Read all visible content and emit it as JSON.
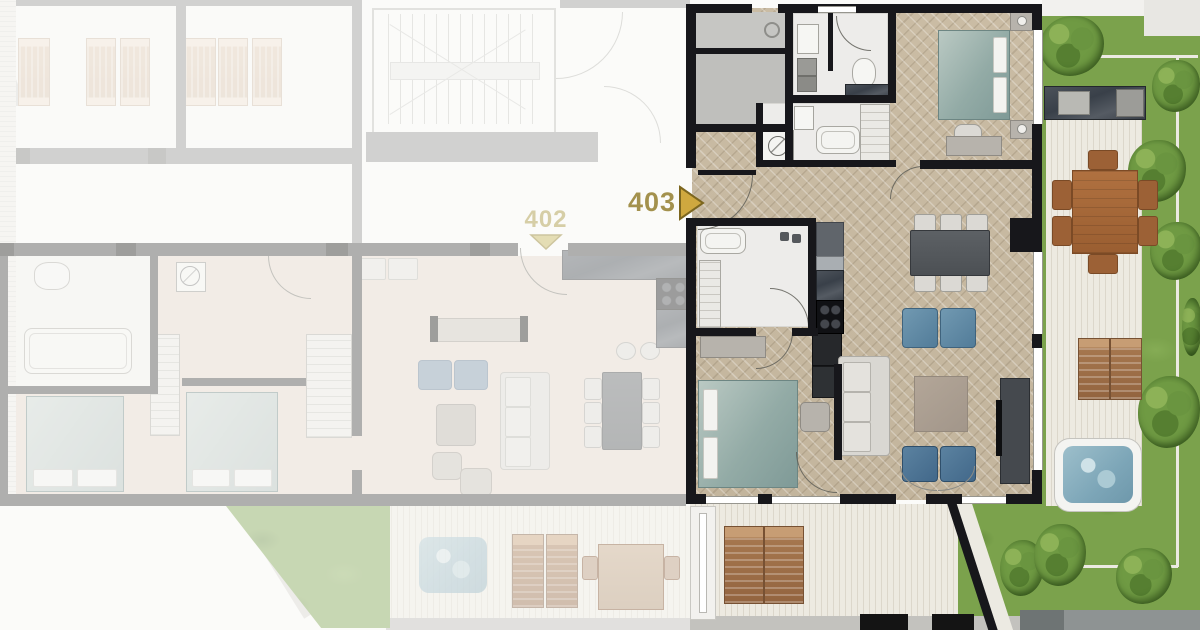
{
  "plan": {
    "view": "residential-floor-plan",
    "units": [
      {
        "label": "403",
        "state": "highlighted",
        "marker": "right-arrow"
      },
      {
        "label": "402",
        "state": "faded",
        "marker": "down-arrow"
      }
    ],
    "palette": {
      "accent_gold": "#c7a53f",
      "label_gold": "#a3914d",
      "wall": "#17171b",
      "wood_floor": "#c8baa2",
      "grass": "#7ba24c",
      "deck": "#e7e3d9",
      "water": "#86abbc",
      "bed_teal": "#9db3ae",
      "upholstery_blue": "#5d86a3",
      "outdoor_wood": "#a8693c"
    }
  }
}
